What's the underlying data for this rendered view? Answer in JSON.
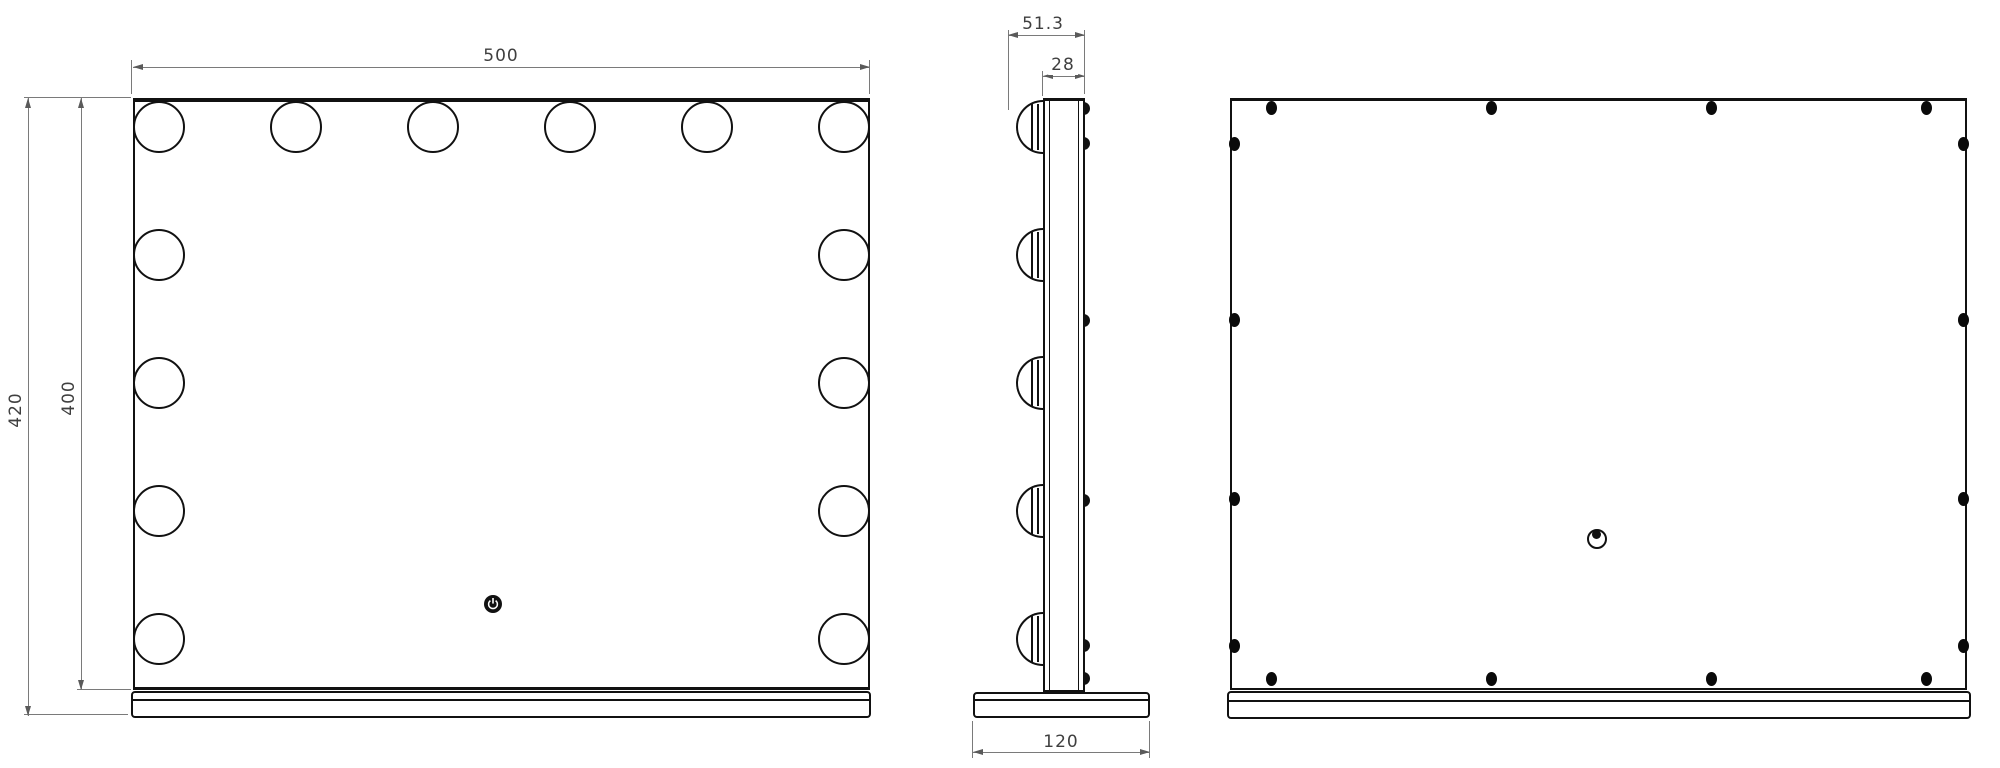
{
  "dimensions": {
    "front_width": "500",
    "overall_height": "420",
    "mirror_height": "400",
    "overall_depth": "51.3",
    "panel_depth": "28",
    "base_depth": "120"
  },
  "icons": {
    "power_button": "power-icon",
    "hanging_hole": "keyhole-icon"
  },
  "colors": {
    "object_line": "#111111",
    "dimension_line": "#7a7a7a",
    "dimension_text": "#3f3f3f",
    "background": "#ffffff"
  },
  "geometry": {
    "front": {
      "bulb_diameter": 52,
      "bulb_centers": [
        [
          159,
          127
        ],
        [
          296,
          127
        ],
        [
          433,
          127
        ],
        [
          570,
          127
        ],
        [
          707,
          127
        ],
        [
          844,
          127
        ],
        [
          159,
          255
        ],
        [
          159,
          383
        ],
        [
          159,
          511
        ],
        [
          159,
          639
        ],
        [
          844,
          255
        ],
        [
          844,
          383
        ],
        [
          844,
          511
        ],
        [
          844,
          639
        ]
      ]
    },
    "side": {
      "bulb_rows": [
        127,
        255,
        383,
        511,
        639
      ],
      "screw_bump_rows": [
        108,
        143,
        320,
        500,
        645,
        678
      ]
    },
    "back": {
      "screw_rows_x": [
        1271,
        1491,
        1711,
        1926
      ],
      "screw_top_y": 108,
      "screw_bottom_y": 679,
      "screw_cols_y": [
        144,
        320,
        499,
        646
      ],
      "screw_left_x": 1234,
      "screw_right_x": 1963
    }
  }
}
